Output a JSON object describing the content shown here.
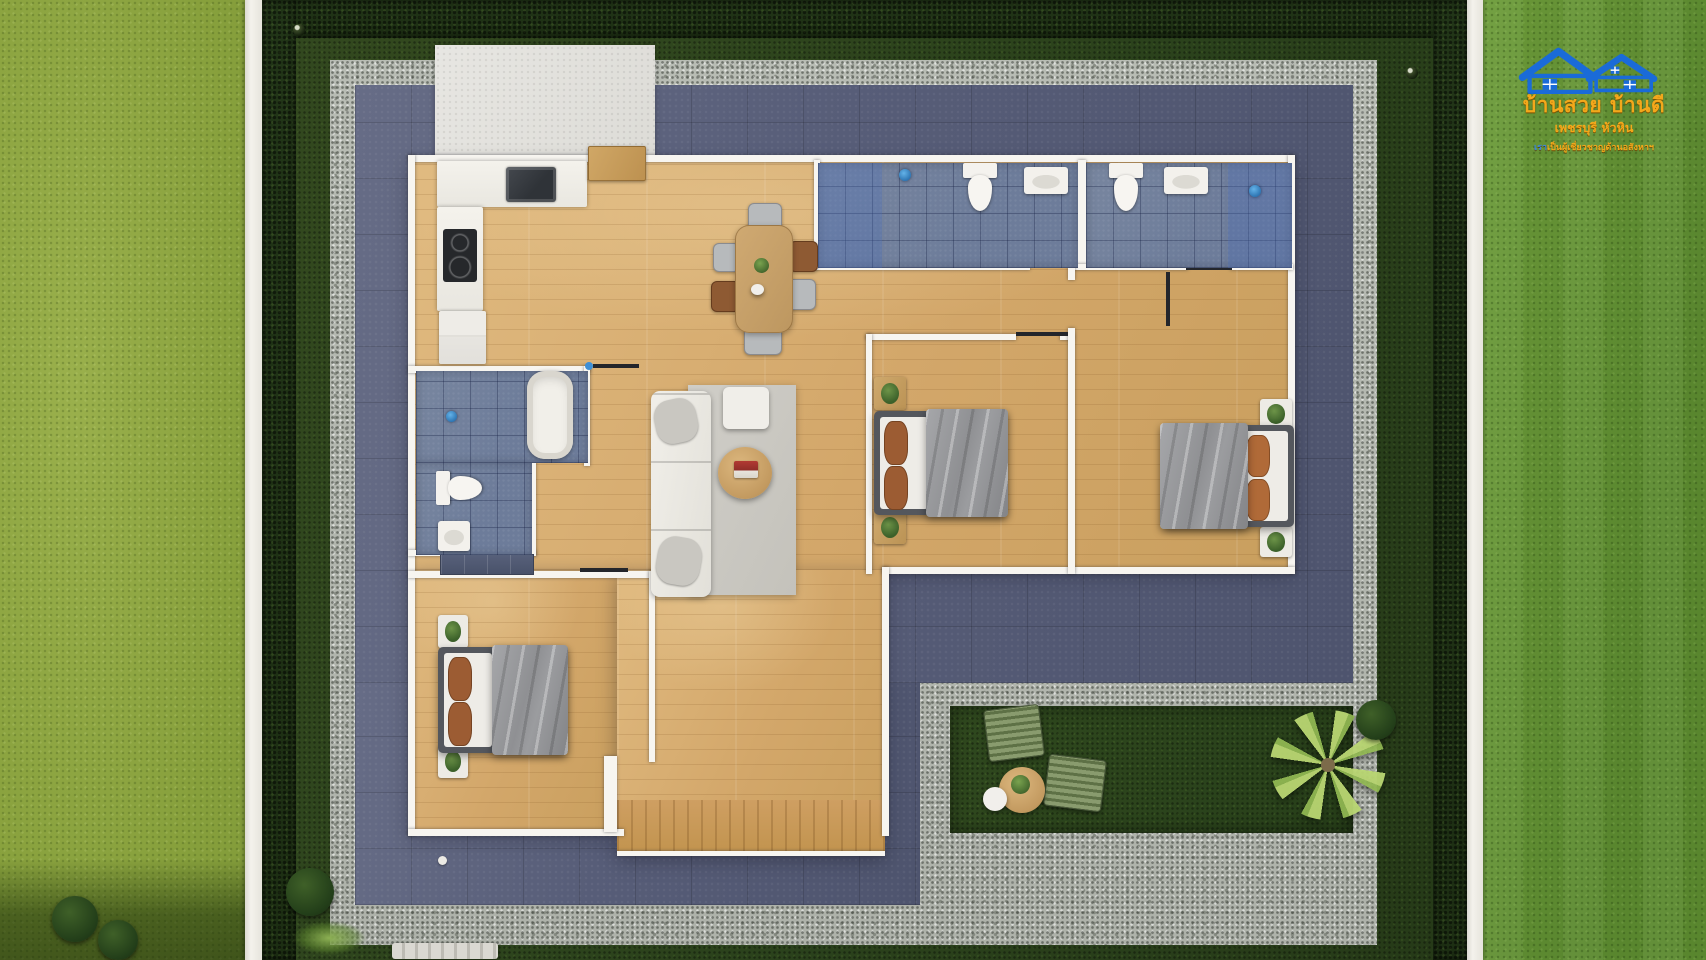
{
  "meta": {
    "description": "Top-down 3D render of a single-storey 3-bedroom house floor plan with terrace, gravel path and garden",
    "canvas": {
      "width": 1706,
      "height": 960
    }
  },
  "logo": {
    "line1": "บ้านสวย บ้านดี",
    "line2": "เพชรบุรี หัวหิน",
    "line3_prefix": "เรา",
    "line3": "เป็นผู้เชี่ยวชาญด้านอสังหาฯ",
    "house_color": "#1a6bd8",
    "text_color": "#f3a81b"
  },
  "palette": {
    "grass_bright": "#8ea43f",
    "grass_right": "#649134",
    "lawn_dark": "#2d431d",
    "hedge": "#20331a",
    "gravel": "#b6bab2",
    "terrace": "#575c77",
    "wood_floor": "#d7ad72",
    "bath_tile": "#72819f",
    "wall_white": "#f7f5f0",
    "fence_white": "#f4f2ec",
    "blanket_gray": "#97989b",
    "pillow_brown": "#9c5c33",
    "lounge_olive": "#7d8f62",
    "logo_blue": "#1a6bd8",
    "logo_orange": "#f3a81b"
  },
  "scene": {
    "elements": [
      {
        "n": "grass-strip-left",
        "c": "grass-bright",
        "x": 0,
        "y": 0,
        "w": 245,
        "h": 960
      },
      {
        "n": "grass-shade-bottom-left",
        "c": "grass-shade",
        "x": 0,
        "y": 858,
        "w": 245,
        "h": 102
      },
      {
        "n": "bush-outside-1",
        "c": "bush",
        "x": 52,
        "y": 896,
        "w": 46,
        "h": 46
      },
      {
        "n": "bush-outside-2",
        "c": "bush",
        "x": 98,
        "y": 920,
        "w": 40,
        "h": 40
      },
      {
        "n": "fence-left",
        "c": "fence",
        "x": 245,
        "y": 0,
        "w": 17,
        "h": 960
      },
      {
        "n": "grass-strip-right",
        "c": "grass-right",
        "x": 1483,
        "y": 0,
        "w": 223,
        "h": 960
      },
      {
        "n": "fence-right",
        "c": "fence",
        "x": 1467,
        "y": 0,
        "w": 16,
        "h": 960
      },
      {
        "n": "plot-lawn",
        "c": "lawn",
        "x": 262,
        "y": 0,
        "w": 1205,
        "h": 960
      },
      {
        "n": "hedge-top",
        "c": "hedge",
        "x": 262,
        "y": 0,
        "w": 1205,
        "h": 38
      },
      {
        "n": "hedge-left",
        "c": "hedge",
        "x": 262,
        "y": 0,
        "w": 34,
        "h": 960
      },
      {
        "n": "hedge-right",
        "c": "hedge",
        "x": 1433,
        "y": 0,
        "w": 34,
        "h": 960
      },
      {
        "n": "sprinkler-dot-1",
        "c": "dot",
        "x": 293,
        "y": 24,
        "w": 12,
        "h": 12
      },
      {
        "n": "sprinkler-dot-2",
        "c": "dot",
        "x": 340,
        "y": 74,
        "w": 11,
        "h": 11
      },
      {
        "n": "sprinkler-dot-3",
        "c": "dot",
        "x": 1406,
        "y": 67,
        "w": 12,
        "h": 12
      },
      {
        "n": "sprinkler-dot-4",
        "c": "dot",
        "x": 1315,
        "y": 626,
        "w": 10,
        "h": 10
      },
      {
        "n": "gravel-path",
        "c": "gravel",
        "x": 330,
        "y": 60,
        "w": 1047,
        "h": 885
      },
      {
        "n": "terrace-main",
        "c": "terrace",
        "x": 355,
        "y": 85,
        "w": 998,
        "h": 598
      },
      {
        "n": "terrace-wing",
        "c": "terrace",
        "x": 355,
        "y": 683,
        "w": 565,
        "h": 222
      },
      {
        "n": "garden-patch",
        "c": "lawn-patch",
        "x": 950,
        "y": 706,
        "w": 403,
        "h": 127
      },
      {
        "n": "entry-pad",
        "c": "pad",
        "x": 435,
        "y": 45,
        "w": 220,
        "h": 118
      },
      {
        "n": "floor-main",
        "c": "floor",
        "x": 410,
        "y": 160,
        "w": 883,
        "h": 410
      },
      {
        "n": "floor-bedroom3",
        "c": "floor",
        "x": 410,
        "y": 570,
        "w": 207,
        "h": 263
      },
      {
        "n": "floor-hall-deck",
        "c": "floor",
        "x": 617,
        "y": 570,
        "w": 268,
        "h": 285
      },
      {
        "n": "deck-boards",
        "c": "deck",
        "x": 617,
        "y": 800,
        "w": 268,
        "h": 51
      },
      {
        "n": "wall-top",
        "c": "wall",
        "x": 408,
        "y": 155,
        "w": 887,
        "h": 7
      },
      {
        "n": "wall-left",
        "c": "wall",
        "x": 408,
        "y": 155,
        "w": 7,
        "h": 681
      },
      {
        "n": "wall-right",
        "c": "wall",
        "x": 1288,
        "y": 155,
        "w": 7,
        "h": 419
      },
      {
        "n": "wall-main-bottom",
        "c": "wall",
        "x": 882,
        "y": 567,
        "w": 413,
        "h": 7
      },
      {
        "n": "wall-wing-right",
        "c": "wall",
        "x": 882,
        "y": 567,
        "w": 7,
        "h": 269
      },
      {
        "n": "wall-wing-bottom",
        "c": "wall",
        "x": 408,
        "y": 829,
        "w": 216,
        "h": 7
      },
      {
        "n": "wall-stub-deck",
        "c": "wall",
        "x": 604,
        "y": 756,
        "w": 13,
        "h": 76
      },
      {
        "n": "deck-edge",
        "c": "wall",
        "x": 617,
        "y": 851,
        "w": 268,
        "h": 5
      },
      {
        "n": "wall-bath-a-left",
        "c": "wall",
        "x": 814,
        "y": 160,
        "w": 6,
        "h": 108
      },
      {
        "n": "wall-bath-divider",
        "c": "wall",
        "x": 1078,
        "y": 160,
        "w": 8,
        "h": 108
      },
      {
        "n": "wall-baths-bottom-1",
        "c": "wall",
        "x": 814,
        "y": 264,
        "w": 216,
        "h": 6
      },
      {
        "n": "wall-baths-bottom-2",
        "c": "wall",
        "x": 1072,
        "y": 264,
        "w": 116,
        "h": 6
      },
      {
        "n": "wall-baths-bottom-3",
        "c": "wall",
        "x": 1230,
        "y": 264,
        "w": 63,
        "h": 6
      },
      {
        "n": "wall-bed1-top-1",
        "c": "wall",
        "x": 866,
        "y": 334,
        "w": 150,
        "h": 6
      },
      {
        "n": "wall-bed1-top-2",
        "c": "wall",
        "x": 1060,
        "y": 334,
        "w": 14,
        "h": 6
      },
      {
        "n": "wall-bed1-left",
        "c": "wall",
        "x": 866,
        "y": 334,
        "w": 6,
        "h": 240
      },
      {
        "n": "wall-beds-divider-top",
        "c": "wall",
        "x": 1068,
        "y": 264,
        "w": 7,
        "h": 16
      },
      {
        "n": "wall-beds-divider",
        "c": "wall",
        "x": 1068,
        "y": 328,
        "w": 7,
        "h": 246
      },
      {
        "n": "wall-bath-c-top",
        "c": "wall",
        "x": 408,
        "y": 366,
        "w": 182,
        "h": 7
      },
      {
        "n": "wall-bath-c-right",
        "c": "wall",
        "x": 584,
        "y": 366,
        "w": 6,
        "h": 100
      },
      {
        "n": "wall-bath-c-bottom",
        "c": "wall",
        "x": 408,
        "y": 550,
        "w": 128,
        "h": 6
      },
      {
        "n": "wall-bath-c-step",
        "c": "wall",
        "x": 530,
        "y": 460,
        "w": 6,
        "h": 96
      },
      {
        "n": "wall-bed3-top",
        "c": "wall",
        "x": 408,
        "y": 571,
        "w": 247,
        "h": 7
      },
      {
        "n": "wall-bed3-right",
        "c": "wall",
        "x": 649,
        "y": 571,
        "w": 6,
        "h": 191
      },
      {
        "n": "window-mark-living",
        "c": "mark",
        "x": 593,
        "y": 364,
        "w": 46,
        "h": 4
      },
      {
        "n": "fixture-dot-living",
        "c": "fixture-dot",
        "x": 585,
        "y": 362,
        "w": 8,
        "h": 8
      },
      {
        "n": "door-mark-bed1",
        "c": "mark",
        "x": 1016,
        "y": 332,
        "w": 52,
        "h": 4
      },
      {
        "n": "window-mark-bed2",
        "c": "mark",
        "x": 1150,
        "y": 264,
        "w": 78,
        "h": 4
      },
      {
        "n": "door-leaf-bed2",
        "c": "mark",
        "x": 1166,
        "y": 272,
        "w": 4,
        "h": 54
      },
      {
        "n": "door-mark-bath-a",
        "c": "mark",
        "x": 1028,
        "y": 262,
        "w": 44,
        "h": 4
      },
      {
        "n": "door-mark-bath-b",
        "c": "mark",
        "x": 1186,
        "y": 266,
        "w": 46,
        "h": 4
      },
      {
        "n": "window-mark-bed3",
        "c": "mark",
        "x": 580,
        "y": 568,
        "w": 48,
        "h": 4
      },
      {
        "n": "shower-arm-a",
        "c": "mark",
        "x": 893,
        "y": 168,
        "w": 4,
        "h": 14
      },
      {
        "n": "shower-arm-b",
        "c": "mark",
        "x": 1253,
        "y": 164,
        "w": 4,
        "h": 20
      },
      {
        "n": "shower-arm-c",
        "c": "mark",
        "x": 441,
        "y": 406,
        "w": 4,
        "h": 14
      },
      {
        "n": "sprinkler-white",
        "c": "dot-white",
        "x": 438,
        "y": 856,
        "w": 9,
        "h": 9
      },
      {
        "n": "wardrobe-bed3",
        "c": "wardrobe",
        "x": 440,
        "y": 554,
        "w": 92,
        "h": 19
      },
      {
        "n": "kitchen-counter-top",
        "c": "counter",
        "x": 437,
        "y": 161,
        "w": 150,
        "h": 46
      },
      {
        "n": "kitchen-sink",
        "c": "sink-dark",
        "x": 506,
        "y": 167,
        "w": 50,
        "h": 35
      },
      {
        "n": "kitchen-counter-left",
        "c": "counter",
        "x": 437,
        "y": 207,
        "w": 46,
        "h": 104
      },
      {
        "n": "cooktop",
        "c": "cooktop",
        "x": 443,
        "y": 229,
        "w": 34,
        "h": 53
      },
      {
        "n": "fridge",
        "c": "fridge",
        "x": 439,
        "y": 311,
        "w": 47,
        "h": 53
      },
      {
        "n": "entry-cabinet",
        "c": "wood-cab",
        "x": 588,
        "y": 146,
        "w": 56,
        "h": 33
      },
      {
        "n": "dining-chair-top",
        "c": "chair-gray",
        "x": 748,
        "y": 203,
        "w": 32,
        "h": 26
      },
      {
        "n": "dining-chair-bottom",
        "c": "chair-gray",
        "x": 744,
        "y": 327,
        "w": 36,
        "h": 26
      },
      {
        "n": "dining-chair-left-1",
        "c": "chair-gray",
        "x": 713,
        "y": 243,
        "w": 25,
        "h": 27
      },
      {
        "n": "dining-chair-left-2",
        "c": "chair-brown",
        "x": 711,
        "y": 281,
        "w": 27,
        "h": 29
      },
      {
        "n": "dining-chair-right-1",
        "c": "chair-brown",
        "x": 789,
        "y": 241,
        "w": 27,
        "h": 29
      },
      {
        "n": "dining-chair-right-2",
        "c": "chair-gray",
        "x": 787,
        "y": 279,
        "w": 27,
        "h": 29
      },
      {
        "n": "dining-table",
        "c": "table-wood",
        "x": 735,
        "y": 225,
        "w": 56,
        "h": 106
      },
      {
        "n": "dining-centerpiece-plant",
        "c": "plant-dot",
        "x": 754,
        "y": 258,
        "w": 15,
        "h": 15
      },
      {
        "n": "dining-dish",
        "c": "stool",
        "x": 751,
        "y": 284,
        "w": 13,
        "h": 11
      },
      {
        "n": "bath-a-tile",
        "c": "tile",
        "x": 818,
        "y": 163,
        "w": 260,
        "h": 105
      },
      {
        "n": "bath-a-shower-zone",
        "c": "tile-shower",
        "x": 818,
        "y": 163,
        "w": 64,
        "h": 105
      },
      {
        "n": "bath-a-showerhead",
        "c": "showerhead",
        "x": 899,
        "y": 169,
        "w": 12,
        "h": 12
      },
      {
        "n": "bath-a-toilet",
        "c": "toilet",
        "x": 960,
        "y": 163,
        "w": 40,
        "h": 50
      },
      {
        "n": "bath-a-sink",
        "c": "sink-white",
        "x": 1024,
        "y": 167,
        "w": 44,
        "h": 27
      },
      {
        "n": "bath-b-tile",
        "c": "tile",
        "x": 1086,
        "y": 163,
        "w": 206,
        "h": 105
      },
      {
        "n": "bath-b-shower-zone",
        "c": "tile-shower",
        "x": 1228,
        "y": 163,
        "w": 64,
        "h": 105
      },
      {
        "n": "bath-b-showerhead",
        "c": "showerhead",
        "x": 1249,
        "y": 185,
        "w": 12,
        "h": 12
      },
      {
        "n": "bath-b-toilet",
        "c": "toilet",
        "x": 1106,
        "y": 163,
        "w": 40,
        "h": 50
      },
      {
        "n": "bath-b-sink",
        "c": "sink-white",
        "x": 1164,
        "y": 167,
        "w": 44,
        "h": 27
      },
      {
        "n": "bath-c-tile-upper",
        "c": "tile",
        "x": 416,
        "y": 371,
        "w": 172,
        "h": 92
      },
      {
        "n": "bath-c-tile-lower",
        "c": "tile",
        "x": 416,
        "y": 463,
        "w": 116,
        "h": 92
      },
      {
        "n": "bathtub",
        "c": "tub",
        "x": 527,
        "y": 371,
        "w": 46,
        "h": 88
      },
      {
        "n": "bath-c-toilet",
        "c": "toilet",
        "x": 440,
        "y": 464,
        "w": 40,
        "h": 48,
        "r": -90
      },
      {
        "n": "bath-c-showerhead",
        "c": "showerhead",
        "x": 446,
        "y": 411,
        "w": 11,
        "h": 11
      },
      {
        "n": "bath-c-sink",
        "c": "sink-white",
        "x": 438,
        "y": 521,
        "w": 32,
        "h": 30
      },
      {
        "n": "living-rug",
        "c": "rug",
        "x": 688,
        "y": 385,
        "w": 108,
        "h": 210
      },
      {
        "n": "sofa",
        "c": "sofa",
        "x": 651,
        "y": 391,
        "w": 60,
        "h": 206
      },
      {
        "n": "sofa-pillow-1",
        "c": "pillow-gray",
        "x": 655,
        "y": 399,
        "w": 42,
        "h": 44,
        "r": -12
      },
      {
        "n": "sofa-pillow-2",
        "c": "pillow-gray",
        "x": 657,
        "y": 537,
        "w": 44,
        "h": 48,
        "r": 10
      },
      {
        "n": "ottoman",
        "c": "ottoman",
        "x": 723,
        "y": 387,
        "w": 46,
        "h": 42
      },
      {
        "n": "coffee-table",
        "c": "round-table",
        "x": 718,
        "y": 447,
        "w": 54,
        "h": 52
      },
      {
        "n": "coffee-table-books",
        "c": "books",
        "x": 734,
        "y": 461,
        "w": 24,
        "h": 17
      },
      {
        "n": "bed1-nightstand-top",
        "c": "nightstand",
        "x": 874,
        "y": 377,
        "w": 32,
        "h": 33
      },
      {
        "n": "bed1-nightstand-bottom",
        "c": "nightstand",
        "x": 874,
        "y": 511,
        "w": 32,
        "h": 33
      },
      {
        "n": "bed1-frame",
        "c": "bed-frame",
        "x": 874,
        "y": 411,
        "w": 132,
        "h": 104
      },
      {
        "n": "bed1-mattress",
        "c": "mattress",
        "x": 880,
        "y": 417,
        "w": 48,
        "h": 92
      },
      {
        "n": "bed1-pillow-1",
        "c": "pillow-brown",
        "x": 884,
        "y": 421,
        "w": 22,
        "h": 42
      },
      {
        "n": "bed1-pillow-2",
        "c": "pillow-brown",
        "x": 884,
        "y": 466,
        "w": 22,
        "h": 42
      },
      {
        "n": "bed1-blanket",
        "c": "blanket",
        "x": 926,
        "y": 409,
        "w": 82,
        "h": 108
      },
      {
        "n": "bed2-nightstand-top",
        "c": "nightstand-white",
        "x": 1260,
        "y": 399,
        "w": 32,
        "h": 30
      },
      {
        "n": "bed2-nightstand-bottom",
        "c": "nightstand-white",
        "x": 1260,
        "y": 527,
        "w": 32,
        "h": 30
      },
      {
        "n": "bed2-frame",
        "c": "bed-frame",
        "x": 1164,
        "y": 425,
        "w": 130,
        "h": 102
      },
      {
        "n": "bed2-mattress",
        "c": "mattress",
        "x": 1238,
        "y": 431,
        "w": 50,
        "h": 90
      },
      {
        "n": "bed2-pillow-1",
        "c": "pillow-orange",
        "x": 1246,
        "y": 435,
        "w": 22,
        "h": 40
      },
      {
        "n": "bed2-pillow-2",
        "c": "pillow-orange",
        "x": 1246,
        "y": 479,
        "w": 22,
        "h": 40
      },
      {
        "n": "bed2-blanket",
        "c": "blanket",
        "x": 1160,
        "y": 423,
        "w": 88,
        "h": 106
      },
      {
        "n": "bed3-nightstand-top",
        "c": "nightstand-white",
        "x": 438,
        "y": 615,
        "w": 30,
        "h": 33
      },
      {
        "n": "bed3-nightstand-bottom",
        "c": "nightstand-white",
        "x": 438,
        "y": 745,
        "w": 30,
        "h": 33
      },
      {
        "n": "bed3-frame",
        "c": "bed-frame",
        "x": 438,
        "y": 647,
        "w": 128,
        "h": 106
      },
      {
        "n": "bed3-mattress",
        "c": "mattress",
        "x": 444,
        "y": 653,
        "w": 48,
        "h": 94
      },
      {
        "n": "bed3-pillow-1",
        "c": "pillow-brown",
        "x": 448,
        "y": 657,
        "w": 22,
        "h": 42
      },
      {
        "n": "bed3-pillow-2",
        "c": "pillow-brown",
        "x": 448,
        "y": 702,
        "w": 22,
        "h": 42
      },
      {
        "n": "bed3-blanket",
        "c": "blanket",
        "x": 492,
        "y": 645,
        "w": 76,
        "h": 110
      },
      {
        "n": "lounge-chair-1",
        "c": "lounge",
        "x": 986,
        "y": 707,
        "w": 54,
        "h": 50,
        "r": -7
      },
      {
        "n": "lounge-chair-2",
        "c": "lounge",
        "x": 1046,
        "y": 757,
        "w": 56,
        "h": 50,
        "r": 7
      },
      {
        "n": "patio-table",
        "c": "round-table",
        "x": 999,
        "y": 767,
        "w": 46,
        "h": 46
      },
      {
        "n": "patio-table-plant",
        "c": "plant-dot",
        "x": 1011,
        "y": 775,
        "w": 19,
        "h": 19
      },
      {
        "n": "patio-stool",
        "c": "stool",
        "x": 983,
        "y": 787,
        "w": 24,
        "h": 24
      },
      {
        "n": "palm-tree",
        "c": "palm",
        "x": 1270,
        "y": 710,
        "w": 116,
        "h": 110
      },
      {
        "n": "bush-right",
        "c": "bush",
        "x": 1356,
        "y": 700,
        "w": 40,
        "h": 40
      },
      {
        "n": "fern-bottom-left",
        "c": "fern",
        "x": 282,
        "y": 916,
        "w": 94,
        "h": 44
      },
      {
        "n": "garden-bench",
        "c": "bench",
        "x": 392,
        "y": 943,
        "w": 106,
        "h": 16
      },
      {
        "n": "bush-bottom-left",
        "c": "bush",
        "x": 286,
        "y": 868,
        "w": 48,
        "h": 48
      }
    ]
  }
}
